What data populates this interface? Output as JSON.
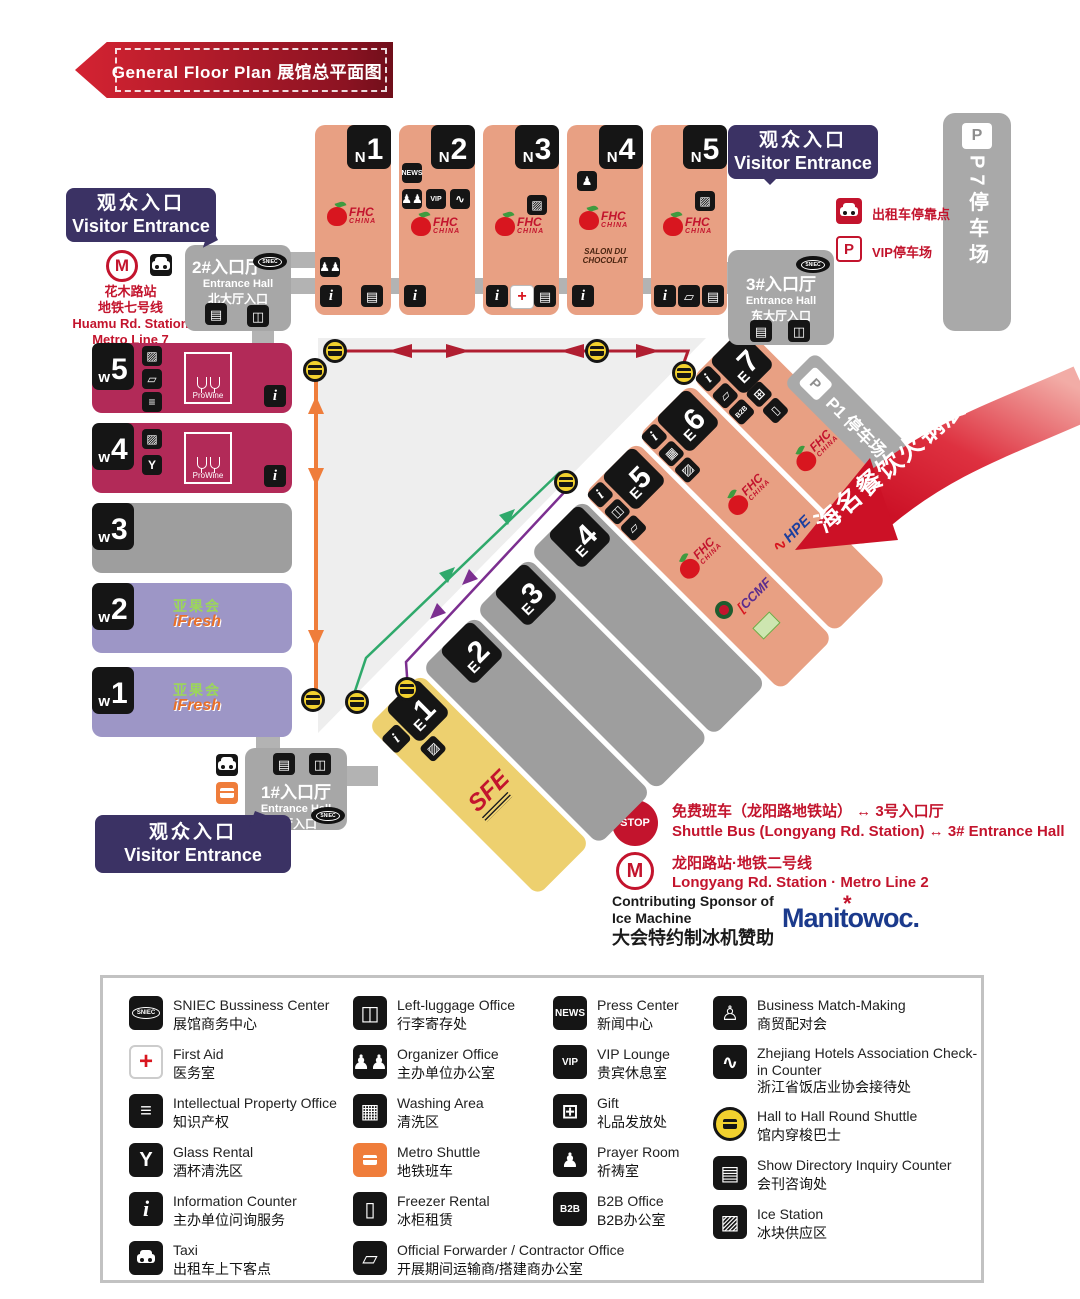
{
  "header": {
    "title_en": "General Floor Plan",
    "title_zh": "展馆总平面图"
  },
  "entrances": {
    "west": {
      "zh": "观众入口",
      "en": "Visitor Entrance"
    },
    "east": {
      "zh": "观众入口",
      "en": "Visitor Entrance"
    },
    "south": {
      "zh": "观众入口",
      "en": "Visitor Entrance"
    }
  },
  "metro_west": {
    "l1": "花木路站",
    "l2": "地铁七号线",
    "l3": "Huamu Rd. Station",
    "l4": "Metro Line 7"
  },
  "entrance_halls": {
    "hall2": {
      "t1": "2#入口厅",
      "t2": "Entrance Hall",
      "t3": "北大厅入口"
    },
    "hall3": {
      "t1": "3#入口厅",
      "t2": "Entrance Hall",
      "t3": "东大厅入口"
    },
    "hall1": {
      "t1": "1#入口厅",
      "t2": "Entrance Hall",
      "t3": "南大厅入口"
    }
  },
  "parking": {
    "p7_label": "P7",
    "p7_text": "停车场",
    "p1": "P1 停车场",
    "vip": "VIP停车场",
    "taxi_stop": "出租车停靠点"
  },
  "halls": {
    "n": [
      {
        "p": "N",
        "num": "1"
      },
      {
        "p": "N",
        "num": "2"
      },
      {
        "p": "N",
        "num": "3"
      },
      {
        "p": "N",
        "num": "4"
      },
      {
        "p": "N",
        "num": "5"
      }
    ],
    "w": [
      {
        "p": "w",
        "num": "5"
      },
      {
        "p": "w",
        "num": "4"
      },
      {
        "p": "w",
        "num": "3"
      },
      {
        "p": "w",
        "num": "2"
      },
      {
        "p": "w",
        "num": "1"
      }
    ],
    "e": [
      {
        "p": "E",
        "num": "1"
      },
      {
        "p": "E",
        "num": "2"
      },
      {
        "p": "E",
        "num": "3"
      },
      {
        "p": "E",
        "num": "4"
      },
      {
        "p": "E",
        "num": "5"
      },
      {
        "p": "E",
        "num": "6"
      },
      {
        "p": "E",
        "num": "7"
      }
    ]
  },
  "logos": {
    "fhc_line1": "FHC",
    "fhc_line2": "CHINA",
    "prowine": "ProWine",
    "ifresh_zh": "亚果会",
    "ifresh_en": "iFresh",
    "sfe": "SFE",
    "salon1": "SALON DU",
    "salon2": "CHOCOLAT",
    "hpe": "HPE",
    "ccmf": "CCMF",
    "manitowoc": "Manitowoc."
  },
  "highlight": {
    "label": "海名餐饮火锅展区"
  },
  "shuttle": {
    "stop": "STOP",
    "zh": "免费班车（龙阳路地铁站） ↔ 3号入口厅",
    "en": "Shuttle Bus (Longyang Rd. Station) ↔ 3# Entrance Hall"
  },
  "metro2": {
    "zh": "龙阳路站·地铁二号线",
    "en": "Longyang Rd. Station · Metro Line 2"
  },
  "sponsor": {
    "en1": "Contributing Sponsor of",
    "en2": "Ice Machine",
    "zh": "大会特约制冰机赞助"
  },
  "colors": {
    "accent_red": "#c3142d",
    "salmon": "#e8a083",
    "crimson": "#b22a58",
    "violet": "#9d96c6",
    "yellow": "#edd06f",
    "gray": "#9e9e9e",
    "bubble_purple": "#3b3264",
    "route_orange": "#ef7d3b",
    "route_green": "#2fa96b",
    "route_purple": "#7c2f90"
  },
  "icons": {
    "info": "i",
    "directory": "▤",
    "luggage": "◫",
    "washing": "▦",
    "freezer": "▯",
    "ice": "▨",
    "ip": "≡",
    "glass": "Y",
    "gift": "⊞",
    "organizer": "♟♟",
    "prayer": "♟",
    "match": "♙",
    "zhejiang": "∿",
    "truck": "▱",
    "news": "NEWS",
    "vip": "VIP",
    "b2b": "B2B",
    "firstaid": "+",
    "sniec": "SNIEC",
    "parking": "P",
    "metro": "M"
  },
  "legend": {
    "col1": [
      {
        "icon": "sniec",
        "en": "SNIEC Bussiness Center",
        "zh": "展馆商务中心"
      },
      {
        "icon": "firstaid",
        "en": "First Aid",
        "zh": "医务室"
      },
      {
        "icon": "ip",
        "en": "Intellectual Property Office",
        "zh": "知识产权"
      },
      {
        "icon": "glass",
        "en": "Glass Rental",
        "zh": "酒杯清洗区"
      },
      {
        "icon": "info",
        "en": "Information Counter",
        "zh": "主办单位问询服务"
      },
      {
        "icon": "taxi",
        "en": "Taxi",
        "zh": "出租车上下客点"
      }
    ],
    "col2": [
      {
        "icon": "luggage",
        "en": "Left-luggage Office",
        "zh": "行李寄存处"
      },
      {
        "icon": "organizer",
        "en": "Organizer Office",
        "zh": "主办单位办公室"
      },
      {
        "icon": "washing",
        "en": "Washing Area",
        "zh": "清洗区"
      },
      {
        "icon": "shuttle",
        "en": "Metro Shuttle",
        "zh": "地铁班车"
      },
      {
        "icon": "freezer",
        "en": "Freezer Rental",
        "zh": "冰柜租赁"
      },
      {
        "icon": "truck",
        "en": "Official Forwarder / Contractor Office",
        "zh": "开展期间运输商/搭建商办公室"
      }
    ],
    "col3": [
      {
        "icon": "news",
        "en": "Press Center",
        "zh": "新闻中心"
      },
      {
        "icon": "vip",
        "en": "VIP Lounge",
        "zh": "贵宾休息室"
      },
      {
        "icon": "gift",
        "en": "Gift",
        "zh": "礼品发放处"
      },
      {
        "icon": "prayer",
        "en": "Prayer Room",
        "zh": "祈祷室"
      },
      {
        "icon": "b2b",
        "en": "B2B Office",
        "zh": "B2B办公室"
      }
    ],
    "col4": [
      {
        "icon": "match",
        "en": "Business Match-Making",
        "zh": "商贸配对会"
      },
      {
        "icon": "zhejiang",
        "en": "Zhejiang Hotels Association Check-in Counter",
        "zh": "浙江省饭店业协会接待处"
      },
      {
        "icon": "bus",
        "en": "Hall to Hall Round Shuttle",
        "zh": "馆内穿梭巴士"
      },
      {
        "icon": "directory",
        "en": "Show Directory Inquiry Counter",
        "zh": "会刊咨询处"
      },
      {
        "icon": "ice",
        "en": "Ice Station",
        "zh": "冰块供应区"
      }
    ]
  }
}
